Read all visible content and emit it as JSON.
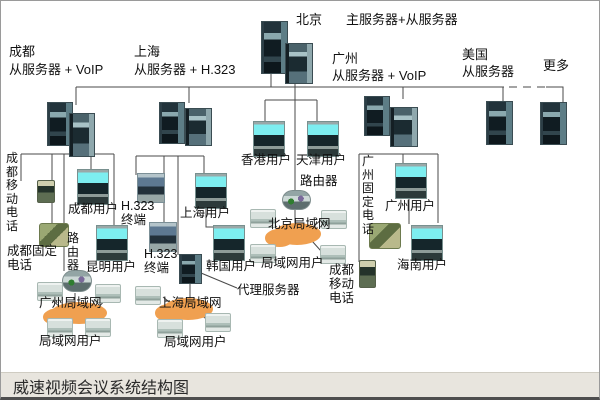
{
  "caption": "威速视频会议系统结构图",
  "regions": {
    "beijing": {
      "city": "北京",
      "server": "主服务器+从服务器"
    },
    "chengdu": {
      "city": "成都",
      "server": "从服务器 + VoIP"
    },
    "shanghai": {
      "city": "上海",
      "server": "从服务器 + H.323"
    },
    "guangzhou": {
      "city": "广州",
      "server": "从服务器 + VoIP"
    },
    "usa": {
      "city": "美国",
      "server": "从服务器"
    },
    "more": {
      "label": "更多"
    }
  },
  "nodes": {
    "hongkong_user": "香港用户",
    "tianjin_user": "天津用户",
    "beijing_router": "路由器",
    "beijing_lan": "北京局域网",
    "beijing_lan_users": "局域网用户",
    "chengdu_mobile_phone": "成都移动电话",
    "chengdu_user": "成都用户",
    "chengdu_fixed_phone": "成都固定电话",
    "chengdu_router": "路由器",
    "kunming_user": "昆明用户",
    "h323_terminal_1": "H.323 终端",
    "h323_terminal_2": "H.323 终端",
    "shanghai_user": "上海用户",
    "korea_user": "韩国用户",
    "proxy_server": "代理服务器",
    "shanghai_lan": "上海局域网",
    "shanghai_lan_users": "局域网用户",
    "guangzhou_lan": "广州局域网",
    "guangzhou_lan_users": "局域网用户",
    "guangzhou_fixed_phone": "广州固定电话",
    "guangzhou_user": "广州用户",
    "hainan_user": "海南用户",
    "chengdu_mobile_phone_2": "成都移动电话"
  },
  "colors": {
    "cloud_orange": "#f0a050",
    "screen_cyan": "#7deef0",
    "caption_bg": "#e8e5de"
  }
}
